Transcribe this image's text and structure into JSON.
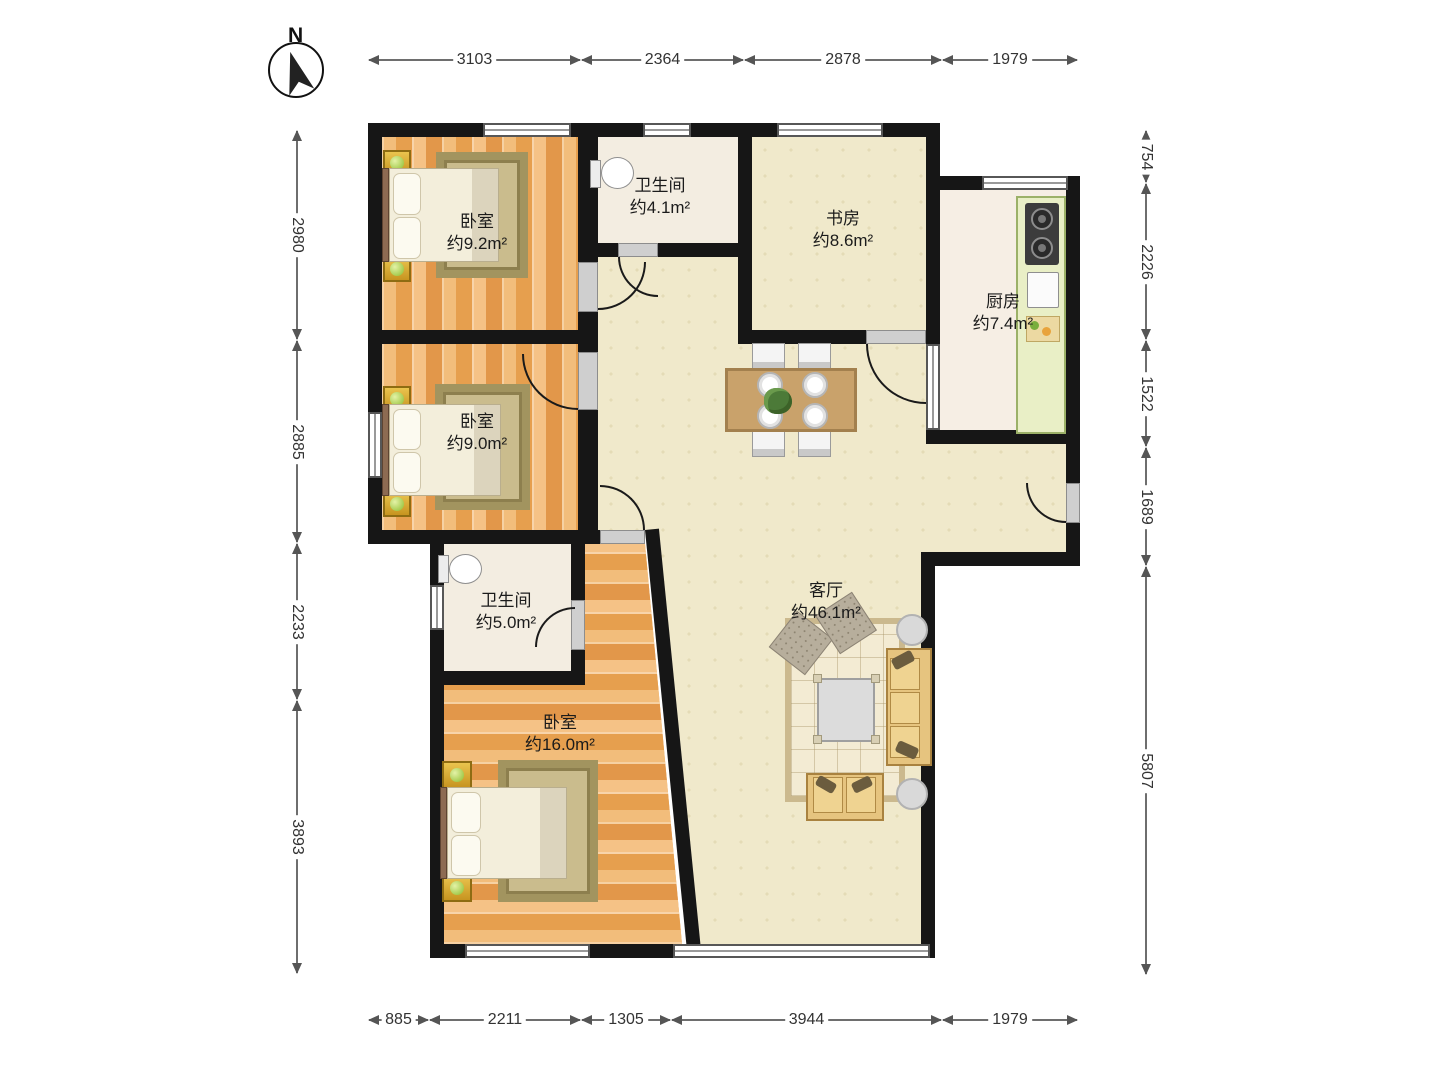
{
  "compass": {
    "label": "N"
  },
  "dimensions": {
    "top": [
      {
        "label": "3103"
      },
      {
        "label": "2364"
      },
      {
        "label": "2878"
      },
      {
        "label": "1979"
      }
    ],
    "bottom": [
      {
        "label": "885"
      },
      {
        "label": "2211"
      },
      {
        "label": "1305"
      },
      {
        "label": "3944"
      },
      {
        "label": "1979"
      }
    ],
    "left": [
      {
        "label": "2980"
      },
      {
        "label": "2885"
      },
      {
        "label": "2233"
      },
      {
        "label": "3893"
      }
    ],
    "right": [
      {
        "label": "754"
      },
      {
        "label": "2226"
      },
      {
        "label": "1522"
      },
      {
        "label": "1689"
      },
      {
        "label": "5807"
      }
    ]
  },
  "rooms": [
    {
      "id": "bedroom-1",
      "name": "卧室",
      "area": "约9.2m²"
    },
    {
      "id": "bathroom-1",
      "name": "卫生间",
      "area": "约4.1m²"
    },
    {
      "id": "study",
      "name": "书房",
      "area": "约8.6m²"
    },
    {
      "id": "kitchen",
      "name": "厨房",
      "area": "约7.4m²"
    },
    {
      "id": "bedroom-2",
      "name": "卧室",
      "area": "约9.0m²"
    },
    {
      "id": "bathroom-2",
      "name": "卫生间",
      "area": "约5.0m²"
    },
    {
      "id": "bedroom-3",
      "name": "卧室",
      "area": "约16.0m²"
    },
    {
      "id": "living-room",
      "name": "客厅",
      "area": "约46.1m²"
    }
  ]
}
